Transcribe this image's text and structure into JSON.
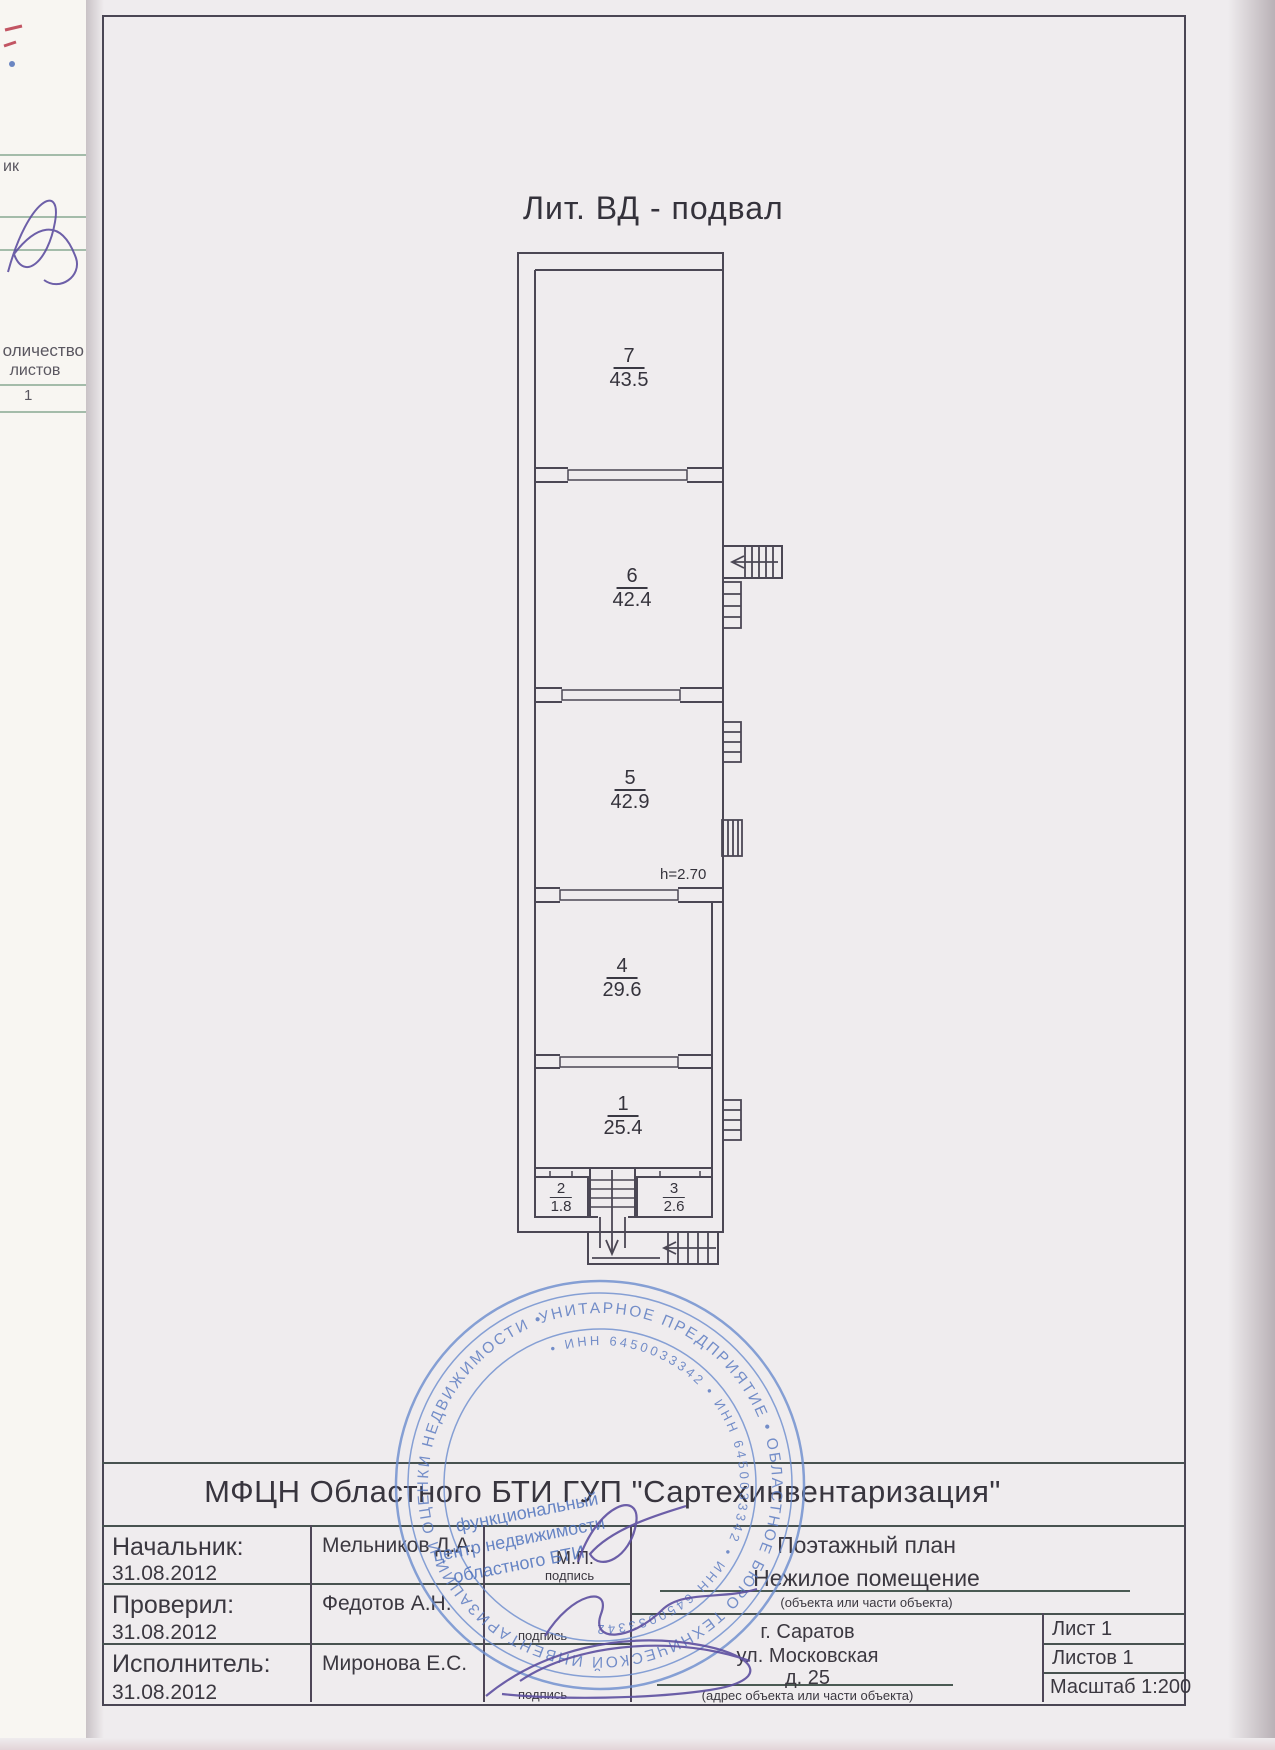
{
  "left_margin": {
    "fragment1": "ик",
    "count_label1": "оличество",
    "count_label2": "листов",
    "sheet_value": "1"
  },
  "plan": {
    "title": "Лит. ВД - подвал",
    "height_note": "h=2.70",
    "rooms": [
      {
        "number": "7",
        "area": "43.5"
      },
      {
        "number": "6",
        "area": "42.4"
      },
      {
        "number": "5",
        "area": "42.9"
      },
      {
        "number": "4",
        "area": "29.6"
      },
      {
        "number": "1",
        "area": "25.4"
      },
      {
        "number": "2",
        "area": "1.8"
      },
      {
        "number": "3",
        "area": "2.6"
      }
    ]
  },
  "title_block": {
    "organization": "МФЦН Областного БТИ ГУП \"Сартехинвентаризация\"",
    "rows": [
      {
        "role": "Начальник:",
        "date": "31.08.2012",
        "name": "Мельников Д.А.",
        "mp": "М.П.",
        "sign_label": "подпись"
      },
      {
        "role": "Проверил:",
        "date": "31.08.2012",
        "name": "Федотов А.Н.",
        "sign_label": "подпись"
      },
      {
        "role": "Исполнитель:",
        "date": "31.08.2012",
        "name": "Миронова Е.С.",
        "sign_label": "подпись"
      }
    ],
    "doc_type": "Поэтажный план",
    "doc_subtype": "Нежилое помещение",
    "doc_note": "(объекта или части объекта)",
    "address_lines": [
      "г. Саратов",
      "ул. Московская",
      "д. 25"
    ],
    "address_note": "(адрес объекта или части объекта)",
    "sheet": "Лист 1",
    "sheets": "Листов 1",
    "scale": "Масштаб 1:200"
  },
  "stamp": {
    "outer_text": "УНИТАРНОЕ ПРЕДПРИЯТИЕ • ОБЛАСТНОЕ БЮРО ТЕХНИЧЕСКОЙ ИНВЕНТАРИЗАЦИИ И ОЦЕНКИ НЕДВИЖИМОСТИ • ",
    "inner_text": "• ИНН 6450033342 • ИНН 6450033342 • ИНН 6450033342",
    "center_line1": "функциональный",
    "center_line2": "центр недвижимости",
    "center_line3": "областного БТИ",
    "color": "#5b7fc4"
  }
}
